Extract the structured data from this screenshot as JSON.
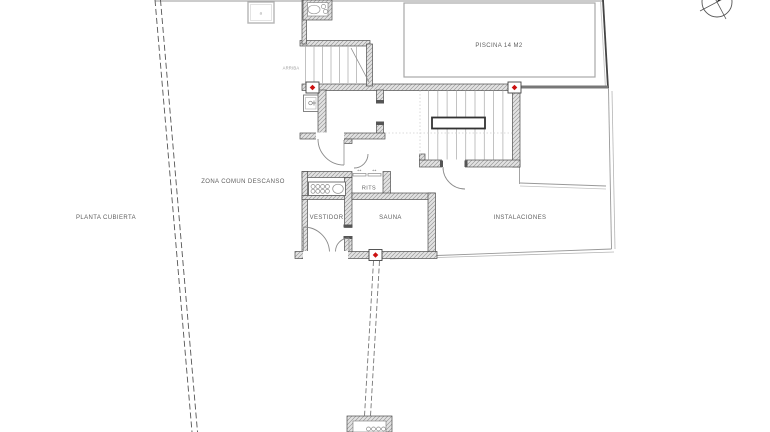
{
  "drawing": {
    "kind": "architectural-floor-plan",
    "labels": {
      "pool": "PISCINA 14 M2",
      "zona_comun": "ZONA COMUN DESCANSO",
      "planta": "PLANTA CUBIERTA",
      "vestidor": "VESTIDOR",
      "sauna": "SAUNA",
      "rits": "RITS",
      "instalaciones": "INSTALACIONES",
      "arriba": "ARRIBA",
      "skylight": "a"
    },
    "icons": {
      "sliding_door_arrow": "↔"
    },
    "colors": {
      "wall_fill": "#e3e3e3",
      "wall_hatch": "#9a9a9a",
      "wall_edge": "#4d4d4d",
      "thin_line": "#8a8a8a",
      "boundary_dash": "#555555",
      "marker_red": "#cc1111",
      "text": "#5f5f5f",
      "pool_border": "#a8a8a8"
    },
    "markers": {
      "count": 3,
      "shape": "red-diamond-in-box"
    }
  }
}
